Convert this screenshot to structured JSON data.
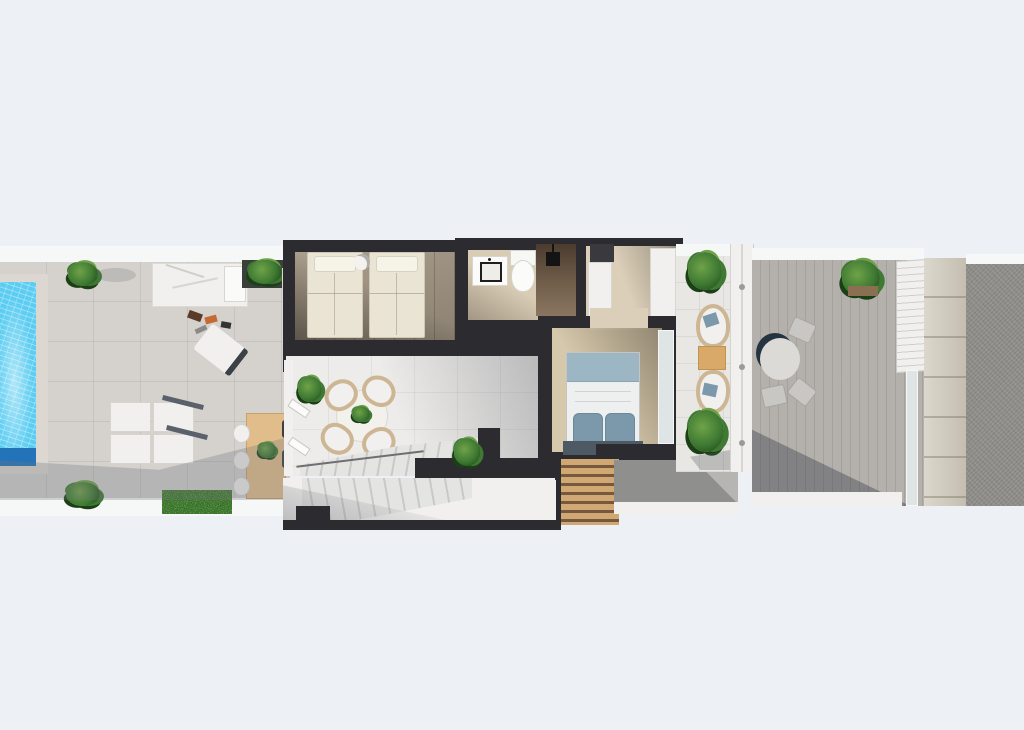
{
  "meta": {
    "kind": "3d-floor-plan-render",
    "view": "top-down",
    "width_px": 1024,
    "height_px": 730,
    "visible_text": "none"
  },
  "colors": {
    "page_bg": "#edf1f6",
    "outer_white": "#f6f7f7",
    "terrace_tile": "#d5d2ce",
    "patio_tile": "#edecea",
    "mid_tile": "#e9e7e3",
    "pool_water": "#5ccdf2",
    "pool_deep": "#2373b9",
    "pool_deck": "#dcd8d1",
    "wall_dark": "#2b2b30",
    "wood_light": "#ab9f8d",
    "wood_dark": "#8b8172",
    "bath_floor": "#d9ccb5",
    "hall_floor": "#dbcfb9",
    "carpet": "#d6c8ab",
    "white_surface": "#f1f0ee",
    "stair_light": "#e4e4e2",
    "stair_dark": "#c9c9c7",
    "sofa_frame": "#5a616a",
    "wood_table": "#e2bd8c",
    "side_table": "#d9a96a",
    "slat_light": "#cfa873",
    "slat_dark": "#77583c",
    "deck_gray": "#b4b1ad",
    "walkway": "#b7b5b1",
    "stone": "#d0cabc",
    "gravel": "#908e8a",
    "plant_light": "#6fa348",
    "plant_mid": "#3f7a33",
    "plant_dark": "#1c4016",
    "hedge_dark": "#202a21",
    "bed_linen": "#eae4d4",
    "bed_white": "#eef0f0",
    "bed_blue_band": "#9db6c4",
    "pillow_blue": "#7c98ab",
    "headboard": "#4e5a63",
    "towel_blue": "#4a7fae",
    "shower_dark": "#6b5846",
    "fixture_black": "#141414",
    "rattan": "#cdb693",
    "glass": "#dfe4e4",
    "table_ring": "#263442"
  },
  "scene": {
    "pool": {
      "name": "swimming-pool"
    },
    "left_terrace": {
      "name": "pool-terrace"
    },
    "daybed": {
      "name": "sun-daybed"
    },
    "sofa": {
      "name": "outdoor-sectional-sofa"
    },
    "dining_table": {
      "name": "outdoor-dining-table"
    },
    "twin_bedroom": {
      "name": "twin-bedroom"
    },
    "closet": {
      "name": "shelved-closet"
    },
    "bathroom": {
      "name": "bathroom"
    },
    "hall": {
      "name": "wardrobe-hallway"
    },
    "master_bedroom": {
      "name": "master-bedroom"
    },
    "patio": {
      "name": "courtyard-patio"
    },
    "bistro_set": {
      "name": "round-patio-table-set"
    },
    "stairs": {
      "name": "staircase"
    },
    "pergola": {
      "name": "wood-slat-pergola"
    },
    "mid_terrace": {
      "name": "bedroom-terrace"
    },
    "lounge_chairs": {
      "name": "terrace-lounge-chairs"
    },
    "right_terrace": {
      "name": "side-deck"
    },
    "deck_table": {
      "name": "deck-round-table"
    },
    "louver_door": {
      "name": "louvered-gate"
    },
    "stone_strip": {
      "name": "stone-wall-strip"
    },
    "gravel_area": {
      "name": "gravel-roof-area"
    }
  }
}
